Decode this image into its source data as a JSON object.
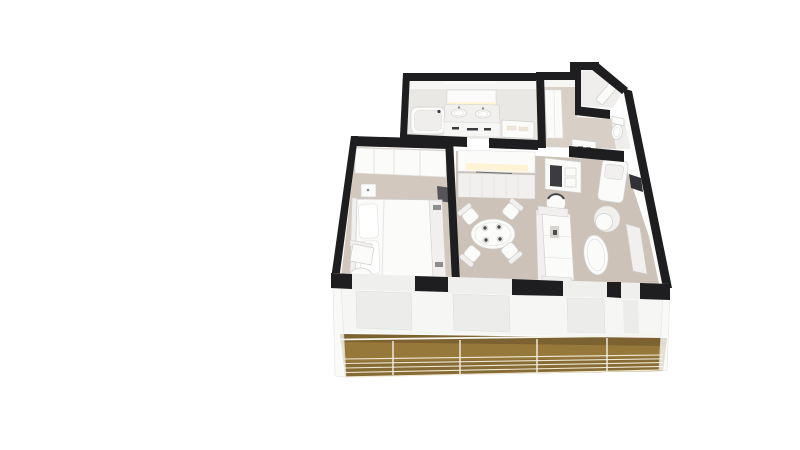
{
  "scene": {
    "kind": "3d-floorplan-cutaway-render",
    "view": "isometric-top",
    "background": "plain-white"
  },
  "palette": {
    "background": "#ffffff",
    "wall_top": "#1e1e20",
    "wall_face": "#f6f6f5",
    "wall_face_light": "#fbfbfa",
    "floor_bathroom": "#eae8e5",
    "floor_entry": "#d8cfc6",
    "floor_wc": "#efeeec",
    "carpet_bedroom": "#d2c8be",
    "carpet_living": "#ccc2b8",
    "furniture": "#fbfbfa",
    "furniture_soft": "#f1f0ee",
    "furniture_stroke": "#cfcfcd",
    "accent_dark": "#3c3c40",
    "accent_mid": "#8e8e90",
    "deck": "#97783b",
    "deck_edge": "#6e5728",
    "railing": "#efe8d4",
    "glow": "#fff3d6",
    "glass": "#ececea",
    "door_inset": "#efefed"
  },
  "rooms": [
    {
      "id": "bathroom",
      "fixtures": [
        "bathtub",
        "double-sink-vanity",
        "vanity-mirror",
        "lighted-strip",
        "towel-cabinet",
        "wall-niche"
      ]
    },
    {
      "id": "entry-hall",
      "fixtures": [
        "entry-door",
        "beveled-corner",
        "corridor-closet",
        "drawer-chest",
        "toilet"
      ]
    },
    {
      "id": "closet-room",
      "fixtures": [
        "door"
      ]
    },
    {
      "id": "bedroom",
      "fixtures": [
        "double-bed",
        "pillows",
        "headboard",
        "sliding-wardrobe",
        "nightstand",
        "dark-bench",
        "armchair",
        "ottoman"
      ]
    },
    {
      "id": "living-dining",
      "fixtures": [
        "sideboard",
        "lighted-niche",
        "writing-desk",
        "desk-blotter",
        "drum-lamp",
        "sofa",
        "chaise-lounge",
        "swivel-armchair",
        "oval-coffee-table",
        "tv-console",
        "dark-wall-panel",
        "round-dining-table",
        "dining-chair",
        "dining-chair",
        "dining-chair",
        "dining-chair"
      ]
    },
    {
      "id": "balcony",
      "fixtures": [
        "wood-deck",
        "glass-railing",
        "railing-posts",
        "sliding-glass-doors",
        "side-panels"
      ]
    }
  ]
}
